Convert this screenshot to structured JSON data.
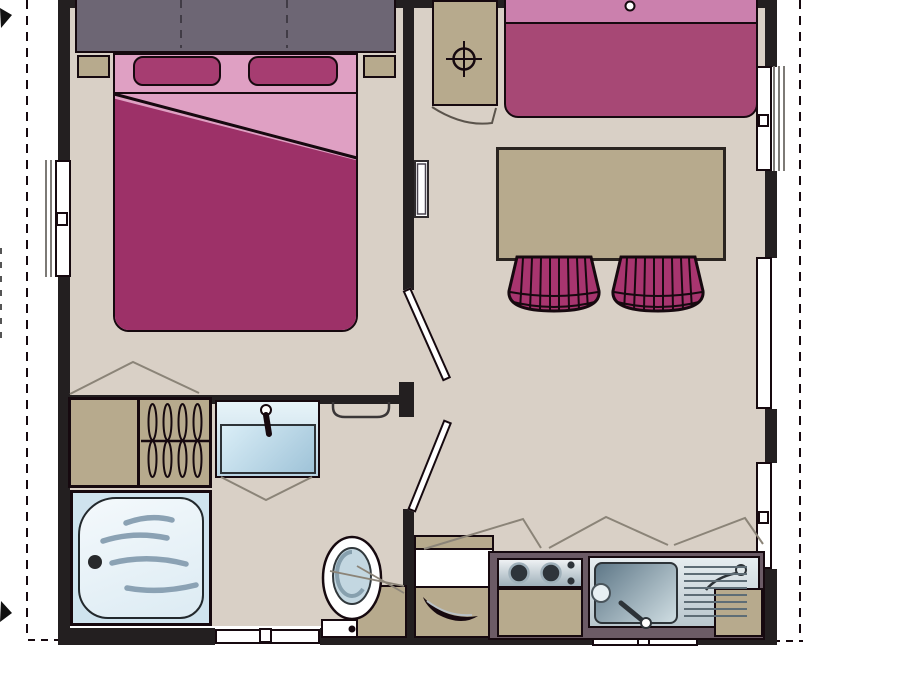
{
  "plan": {
    "type": "floor-plan",
    "colors": {
      "wall": "#231f20",
      "outline": "#16090f",
      "floor": "#d9d0c6",
      "furniture_beige": "#b7aa8d",
      "headboard_gray": "#6d6674",
      "pink_light": "#dfa0c3",
      "magenta": "#9d3168",
      "pillow_magenta": "#a63d71",
      "sofa_seat": "#a74875",
      "sofa_back": "#cb80ad",
      "chair_magenta": "#a8356f",
      "counter_gray": "#6c5b66",
      "steel_light": "#cdd6da",
      "pale_blue": "#cfe3ee",
      "basin_blue": "#9fc3d8",
      "wave_blue": "#8ba2b4",
      "swing_gray": "#8b8478",
      "hatch_gray": "#7d7a76"
    },
    "boundary": {
      "style": "dashed",
      "sides": [
        "left",
        "right",
        "bottom"
      ],
      "corner_marks": [
        "top-left-arrow",
        "bottom-left-arrow"
      ]
    },
    "rooms": [
      {
        "name": "bedroom",
        "items": [
          "headboard-cabinet",
          "double-bed",
          "pillow-left",
          "pillow-right",
          "nightstand-left",
          "nightstand-right",
          "window-left"
        ]
      },
      {
        "name": "living-area",
        "items": [
          "sofa",
          "dining-table",
          "tufted-chair-left",
          "tufted-chair-right",
          "boiler-cabinet",
          "boiler-symbol",
          "wall-heater",
          "window-top",
          "window-right-upper",
          "window-right-middle",
          "window-right-lower",
          "door-bedroom"
        ]
      },
      {
        "name": "bathroom",
        "items": [
          "wardrobe",
          "clothes-hangers",
          "hanging-rail",
          "washbasin",
          "tap",
          "towel-rail",
          "bathtub",
          "bath-drain",
          "toilet",
          "toilet-cistern",
          "storage-cabinet",
          "window-bottom-bath",
          "door-bathroom"
        ]
      },
      {
        "name": "kitchen",
        "items": [
          "worktop",
          "two-burner-hob",
          "sink",
          "drainboard",
          "faucet",
          "base-cabinet-left",
          "appliance-front",
          "base-cabinet-under-hob",
          "base-cabinet-right",
          "cabinet-handle",
          "window-bottom-kitchen"
        ]
      }
    ]
  }
}
